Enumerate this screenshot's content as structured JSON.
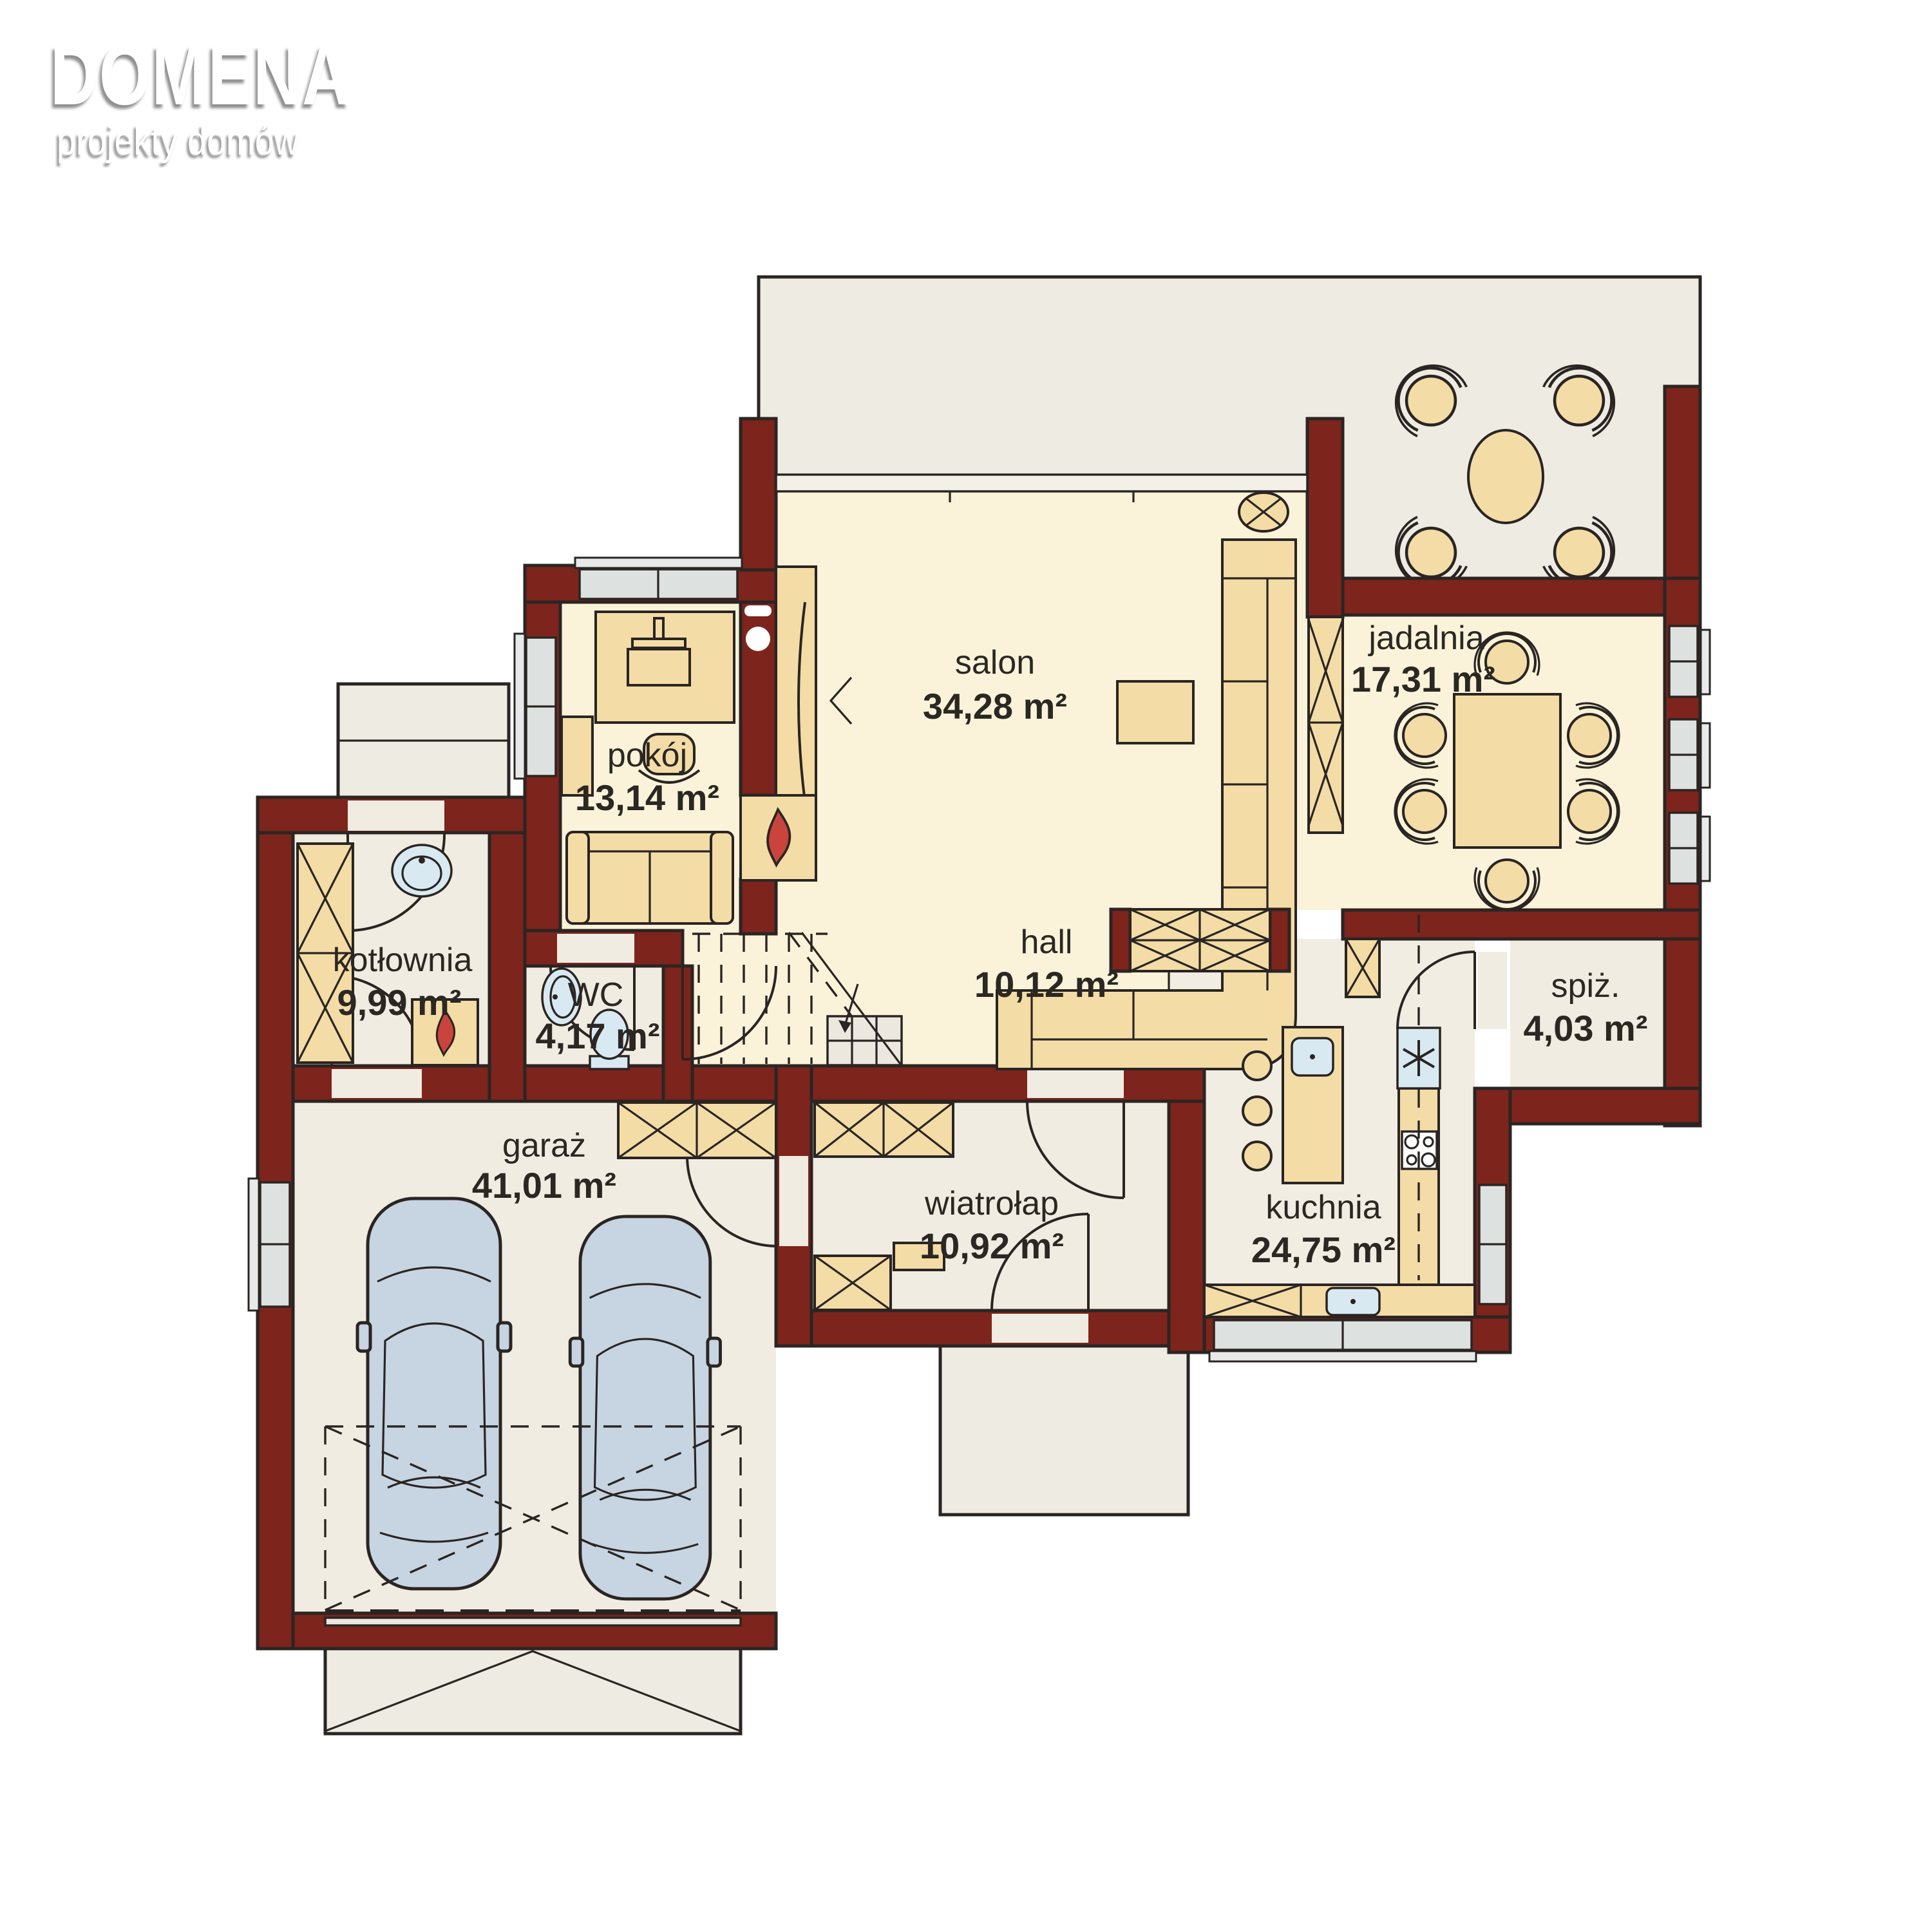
{
  "logo": {
    "brand": "DOMENA",
    "tagline": "projekty domów"
  },
  "rooms": {
    "pokoj": {
      "name": "pokój",
      "area": "13,14 m²"
    },
    "salon": {
      "name": "salon",
      "area": "34,28 m²"
    },
    "jadalnia": {
      "name": "jadalnia",
      "area": "17,31 m²"
    },
    "kotlownia": {
      "name": "kotłownia",
      "area": "9,99 m²"
    },
    "wc": {
      "name": "WC",
      "area": "4,17 m²"
    },
    "hall": {
      "name": "hall",
      "area": "10,12 m²"
    },
    "spiz": {
      "name": "spiż.",
      "area": "4,03 m²"
    },
    "garaz": {
      "name": "garaż",
      "area": "41,01 m²"
    },
    "wiatrolap": {
      "name": "wiatrołap",
      "area": "10,92 m²"
    },
    "kuchnia": {
      "name": "kuchnia",
      "area": "24,75 m²"
    }
  },
  "colors": {
    "wall": "#7d241d",
    "floor_warm": "#faf3d9",
    "floor_cool": "#f1ece1",
    "terrace": "#eeebe2",
    "furniture": "#f3dca6",
    "window": "#dde1e0",
    "fixture": "#d9e9f2",
    "car": "#c7d4e2",
    "flame": "#c8443c",
    "outline": "#2a2522"
  }
}
